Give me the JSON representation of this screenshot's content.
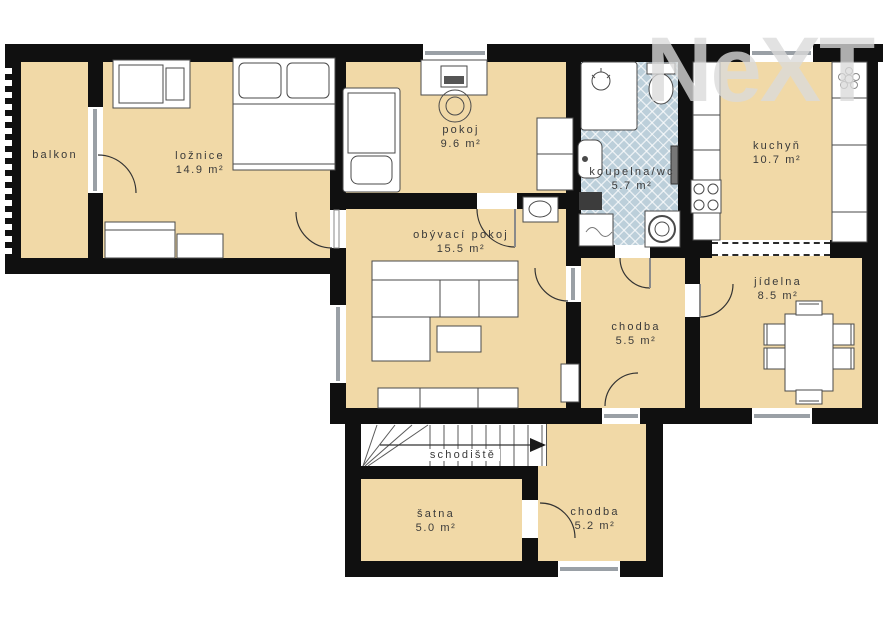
{
  "watermark": "NeXT",
  "colors": {
    "floor": "#f1d9a7",
    "wall": "#101010",
    "bath_floor": "#bccfda",
    "window_gray": "#9aa0a6"
  },
  "rooms": {
    "balkon": {
      "label": "balkon",
      "area": ""
    },
    "loznice": {
      "label": "ložnice",
      "area": "14.9 m²"
    },
    "pokoj": {
      "label": "pokoj",
      "area": "9.6 m²"
    },
    "koupelna": {
      "label": "koupelna/wc",
      "area": "5.7 m²"
    },
    "kuchyn": {
      "label": "kuchyň",
      "area": "10.7 m²"
    },
    "obyvaci_pokoj": {
      "label": "obývací pokoj",
      "area": "15.5 m²"
    },
    "chodba_horni": {
      "label": "chodba",
      "area": "5.5 m²"
    },
    "jidelna": {
      "label": "jídelna",
      "area": "8.5 m²"
    },
    "schodiste": {
      "label": "schodiště",
      "area": ""
    },
    "satna": {
      "label": "šatna",
      "area": "5.0 m²"
    },
    "chodba_dolni": {
      "label": "chodba",
      "area": "5.2 m²"
    }
  }
}
